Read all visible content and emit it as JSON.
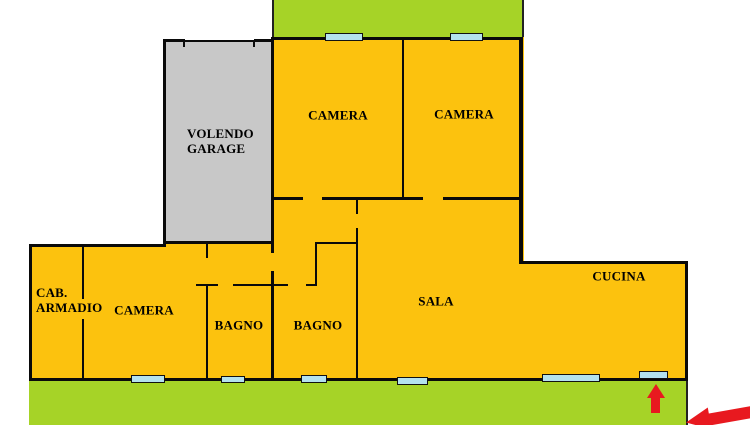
{
  "rooms": {
    "garage": {
      "label": "VOLENDO\nGARAGE"
    },
    "camera_top_left": {
      "label": "CAMERA"
    },
    "camera_top_right": {
      "label": "CAMERA"
    },
    "camera_bottom": {
      "label": "CAMERA"
    },
    "cab_armadio": {
      "label": "CAB.\nARMADIO"
    },
    "bagno_left": {
      "label": "BAGNO"
    },
    "bagno_right": {
      "label": "BAGNO"
    },
    "sala": {
      "label": "SALA"
    },
    "cucina": {
      "label": "CUCINA"
    }
  },
  "colors": {
    "floor_yellow": "#fcc20e",
    "garden_green": "#a6d327",
    "garage_gray": "#c8c8c8",
    "window_blue": "#b4e2ee",
    "arrow_red": "#e8191f",
    "wall_black": "#0a0a0a"
  },
  "icons": {
    "entrance_arrow": "red-arrow-up",
    "corner_arrow": "red-arrow-left"
  }
}
